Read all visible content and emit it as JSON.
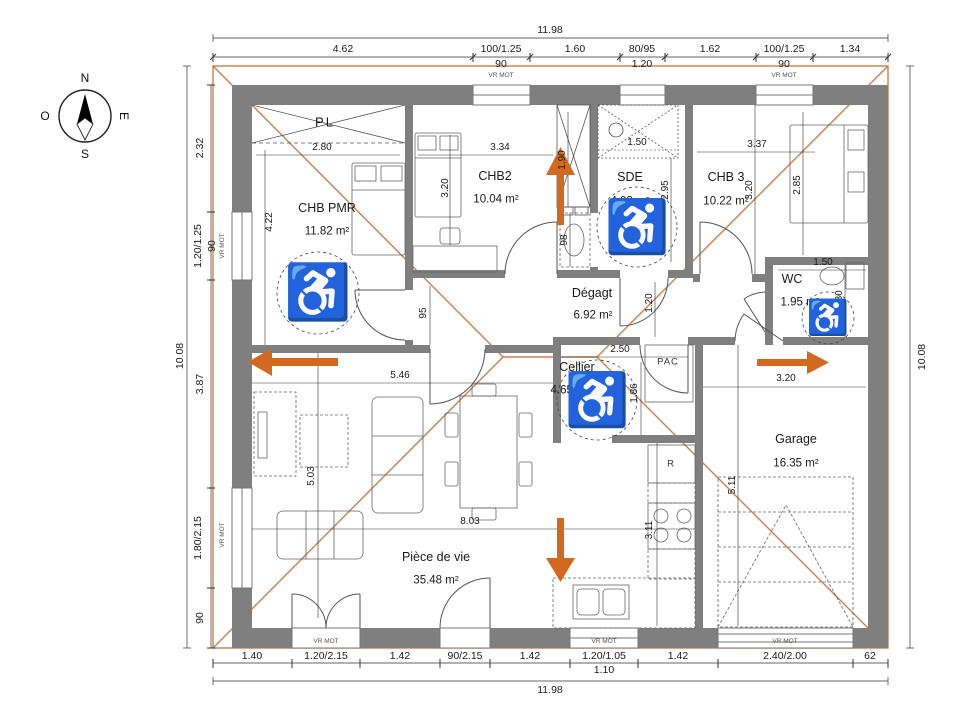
{
  "compass": {
    "north": "N",
    "south": "S",
    "east": "E",
    "west": "O"
  },
  "chains": {
    "top": {
      "overall": "11.98",
      "segments": [
        "4.62",
        "100/1.25",
        "1.60",
        "80/95",
        "1.62",
        "100/1.25",
        "1.34"
      ],
      "sub_left_90": "90",
      "sub_mid_120": "1.20",
      "sub_right_90": "90",
      "shutter_left": "VR MOT",
      "shutter_right": "VR MOT"
    },
    "bottom": {
      "overall": "11.98",
      "segments": [
        "1.40",
        "1.20/2.15",
        "1.42",
        "90/2.15",
        "1.42",
        "1.20/1.05",
        "1.42",
        "2.40/2.00",
        "62"
      ],
      "sub_window_110": "1.10",
      "shutters": [
        "VR MOT",
        "VR MOT",
        "VR MOT"
      ]
    },
    "left": {
      "overall": "10.08",
      "segments": [
        "2.32",
        "1.20/1.25",
        "3.87",
        "1.80/2.15",
        "90"
      ],
      "sub_90": "90",
      "shutters": [
        "VR MOT",
        "VR MOT"
      ]
    },
    "right": {
      "overall": "10.08"
    }
  },
  "rooms": {
    "chb_pmr": {
      "name": "CHB PMR",
      "area": "11.82 m²"
    },
    "chb2": {
      "name": "CHB2",
      "area": "10.04 m²"
    },
    "sde": {
      "name": "SDE",
      "area": "4.93 m²"
    },
    "chb3": {
      "name": "CHB 3",
      "area": "10.22 m²"
    },
    "wc": {
      "name": "WC",
      "area": "1.95 m²"
    },
    "degagement": {
      "name": "Dégagt",
      "area": "6.92 m²"
    },
    "cellier": {
      "name": "Cellier",
      "area": "4.65 m²"
    },
    "garage": {
      "name": "Garage",
      "area": "16.35 m²"
    },
    "piece_de_vie": {
      "name": "Pièce de vie",
      "area": "35.48 m²"
    }
  },
  "equipment": {
    "closet": "PL",
    "heat_pump": "PAC",
    "fridge": "R"
  },
  "dims": {
    "pmr_width": "2.80",
    "pmr_depth": "4.22",
    "chb2_width": "3.34",
    "chb2_depth": "3.20",
    "entry_closet": "1.90",
    "vanity_width": "98",
    "sde_width": "1.50",
    "sde_depth": "2.95",
    "chb3_width": "3.37",
    "chb3_depth": "3.20",
    "chb3_bed": "2.85",
    "wc_width": "1.50",
    "wc_depth": "1.30",
    "hall_width": "95",
    "hall_door": "1.20",
    "cellier_width": "2.50",
    "cellier_depth": "1.86",
    "garage_width": "3.20",
    "garage_depth": "5.11",
    "living_top": "5.46",
    "living_depth": "5.03",
    "living_width": "8.03",
    "kitchen_depth": "3.11"
  },
  "icons": {
    "wheelchair": "♿"
  },
  "colors": {
    "wall": "#7f7f7f",
    "roof_line": "#c8814e",
    "arrow": "#d2691e",
    "dim_text": "#1a1a1a"
  }
}
